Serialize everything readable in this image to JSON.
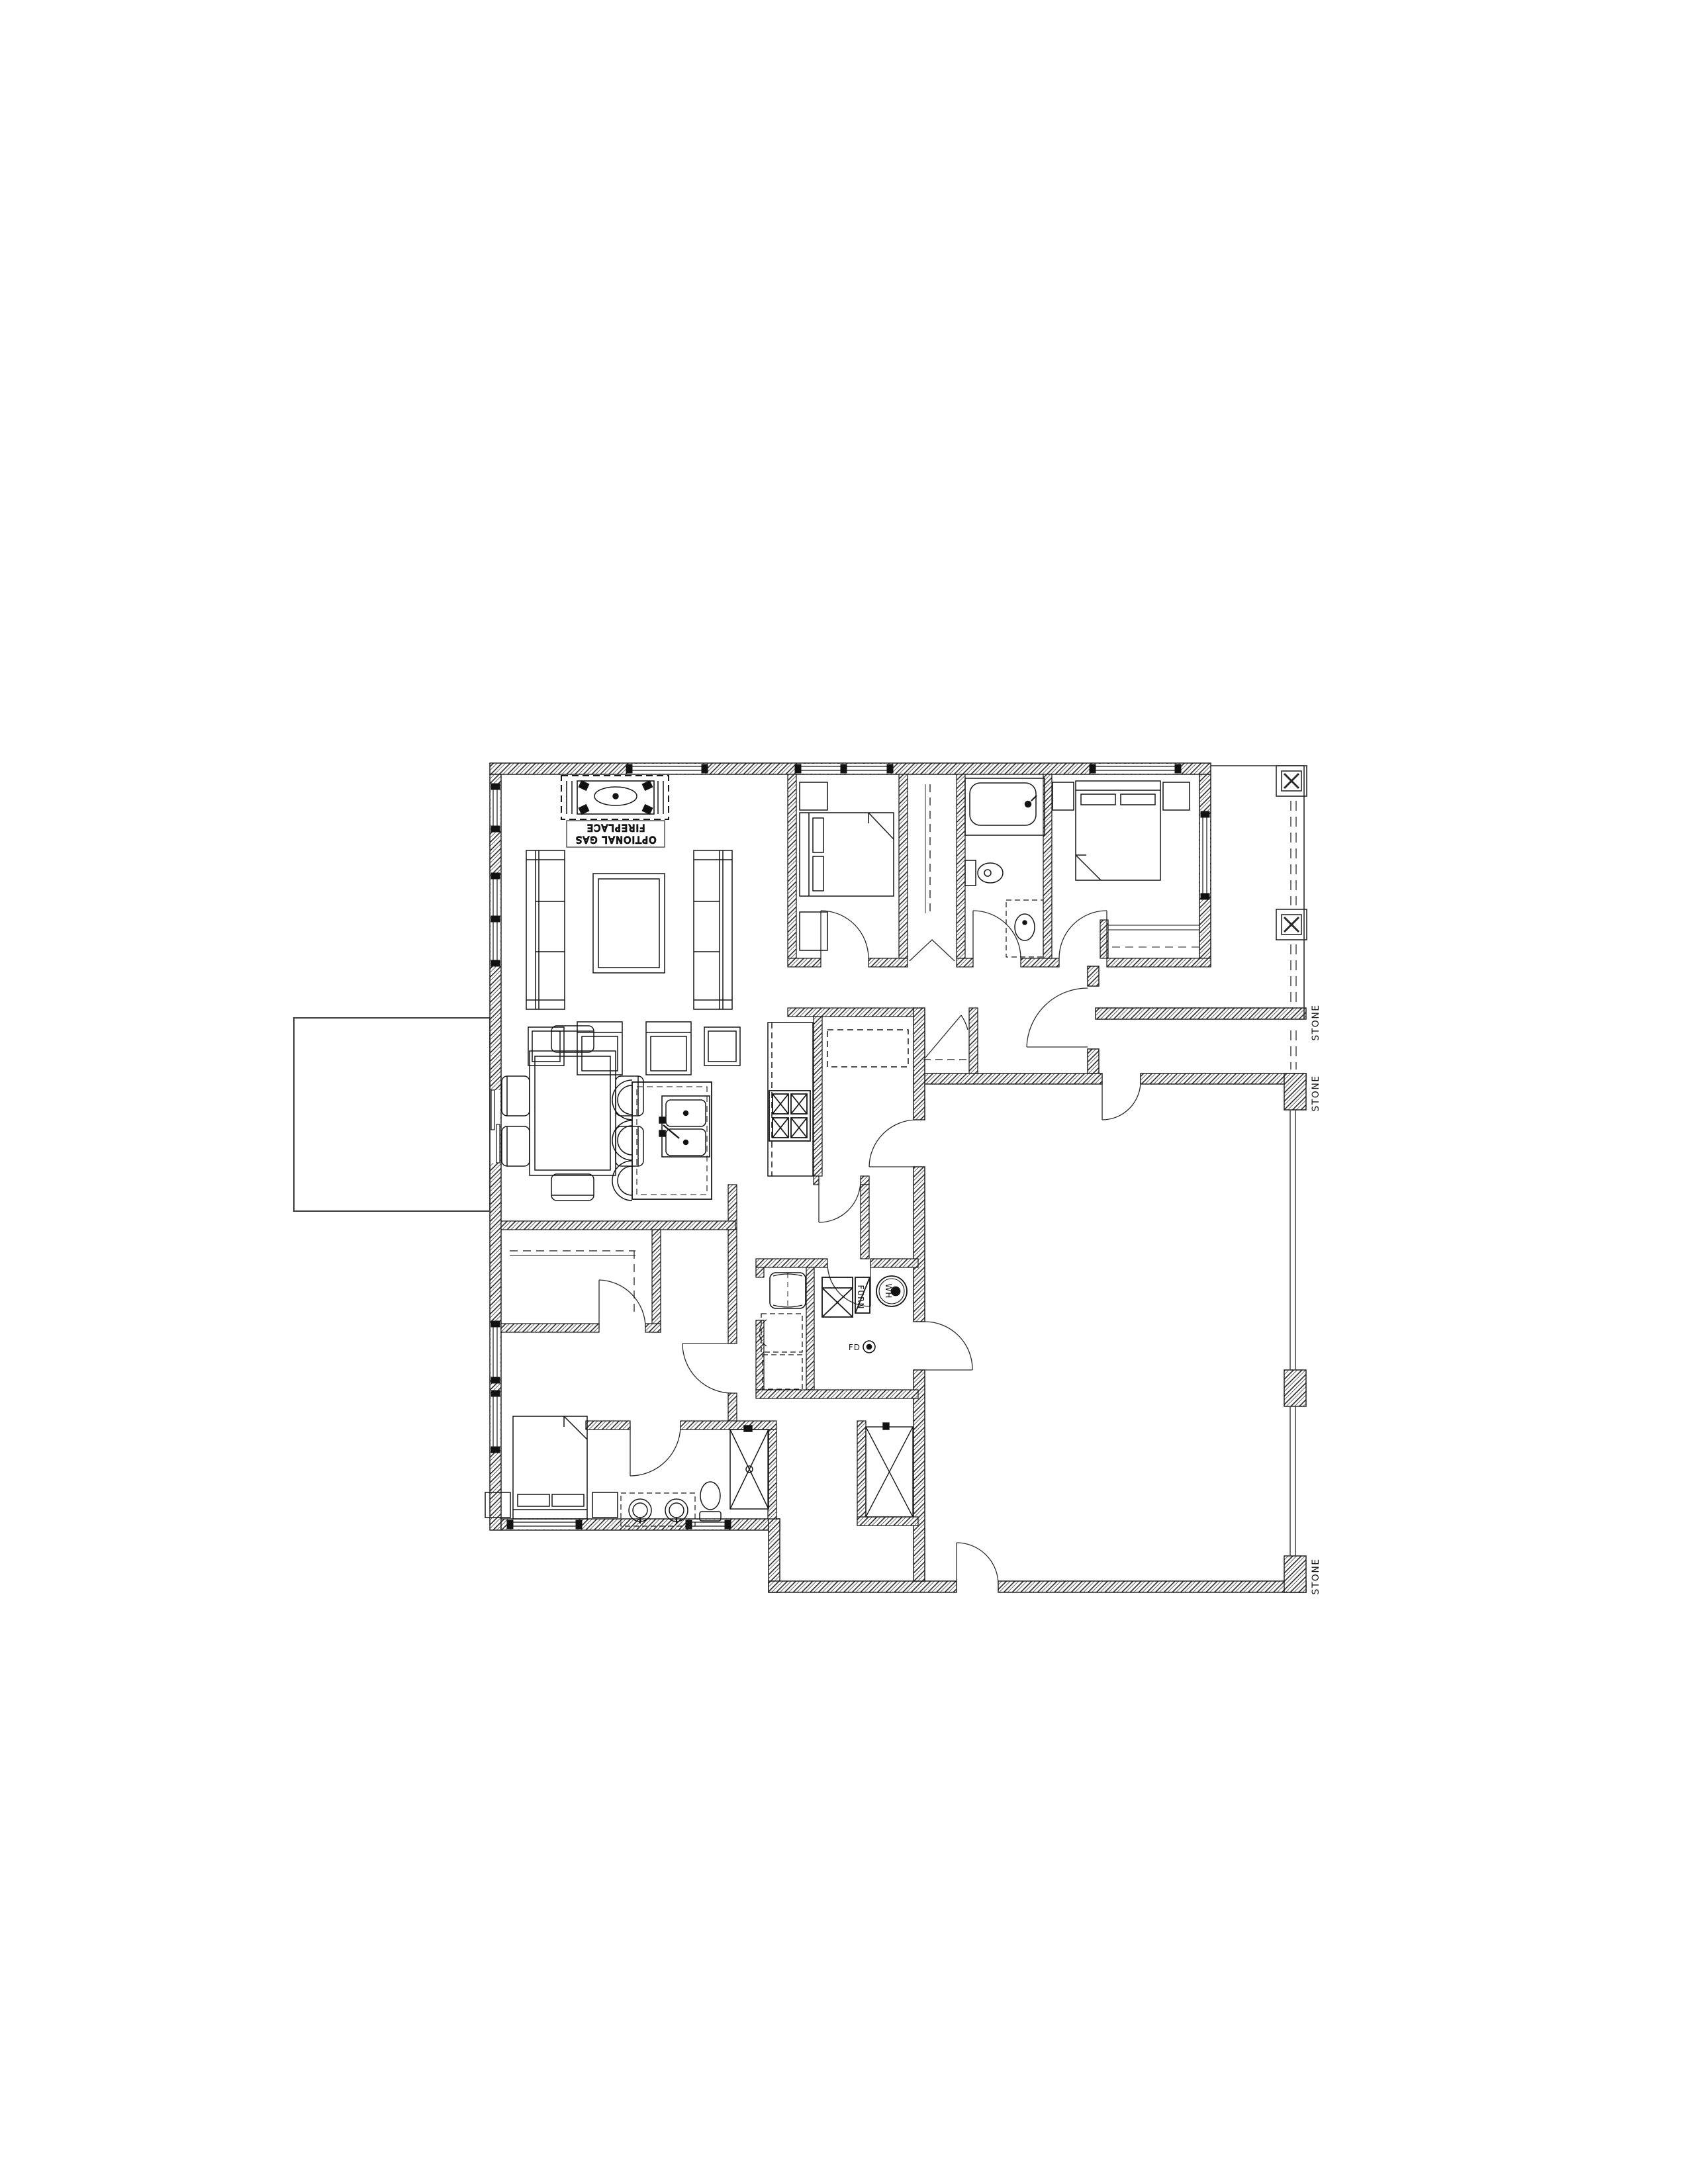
{
  "page": {
    "background": "#ffffff",
    "ink": "#1a1a1a",
    "type": "architectural-floor-plan"
  },
  "labels": {
    "fireplace_optional_line1": "OPTIONAL GAS",
    "fireplace_optional_line2": "FIREPLACE",
    "stone": "STONE",
    "furnace": "FURN",
    "water_heater": "WH",
    "floor_drain": "FD"
  }
}
